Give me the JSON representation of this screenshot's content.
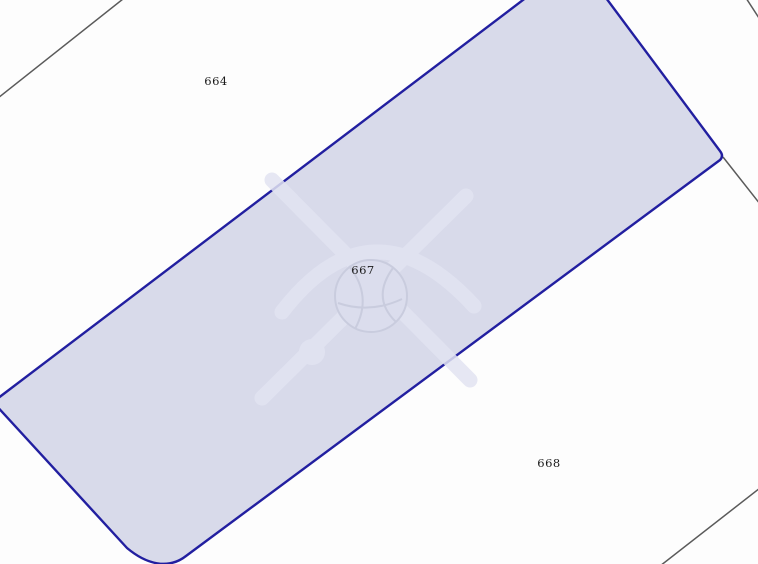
{
  "map_type": "cadastral-parcel-map",
  "canvas": {
    "width": 758,
    "height": 564,
    "background_color": "#fdfdfd"
  },
  "parcels": [
    {
      "number": "664",
      "highlighted": false
    },
    {
      "number": "667",
      "highlighted": true
    },
    {
      "number": "668",
      "highlighted": false
    }
  ],
  "labels": {
    "color": "#1a1a1a"
  },
  "highlight": {
    "fill": "#d8daea",
    "stroke": "#221fa0"
  },
  "boundaries": {
    "color": "#5a5a5a"
  },
  "watermark": {
    "band_color": "#e2e4f2",
    "shade_color": "#c7cadc",
    "ball_fill": "#dcdeee"
  }
}
